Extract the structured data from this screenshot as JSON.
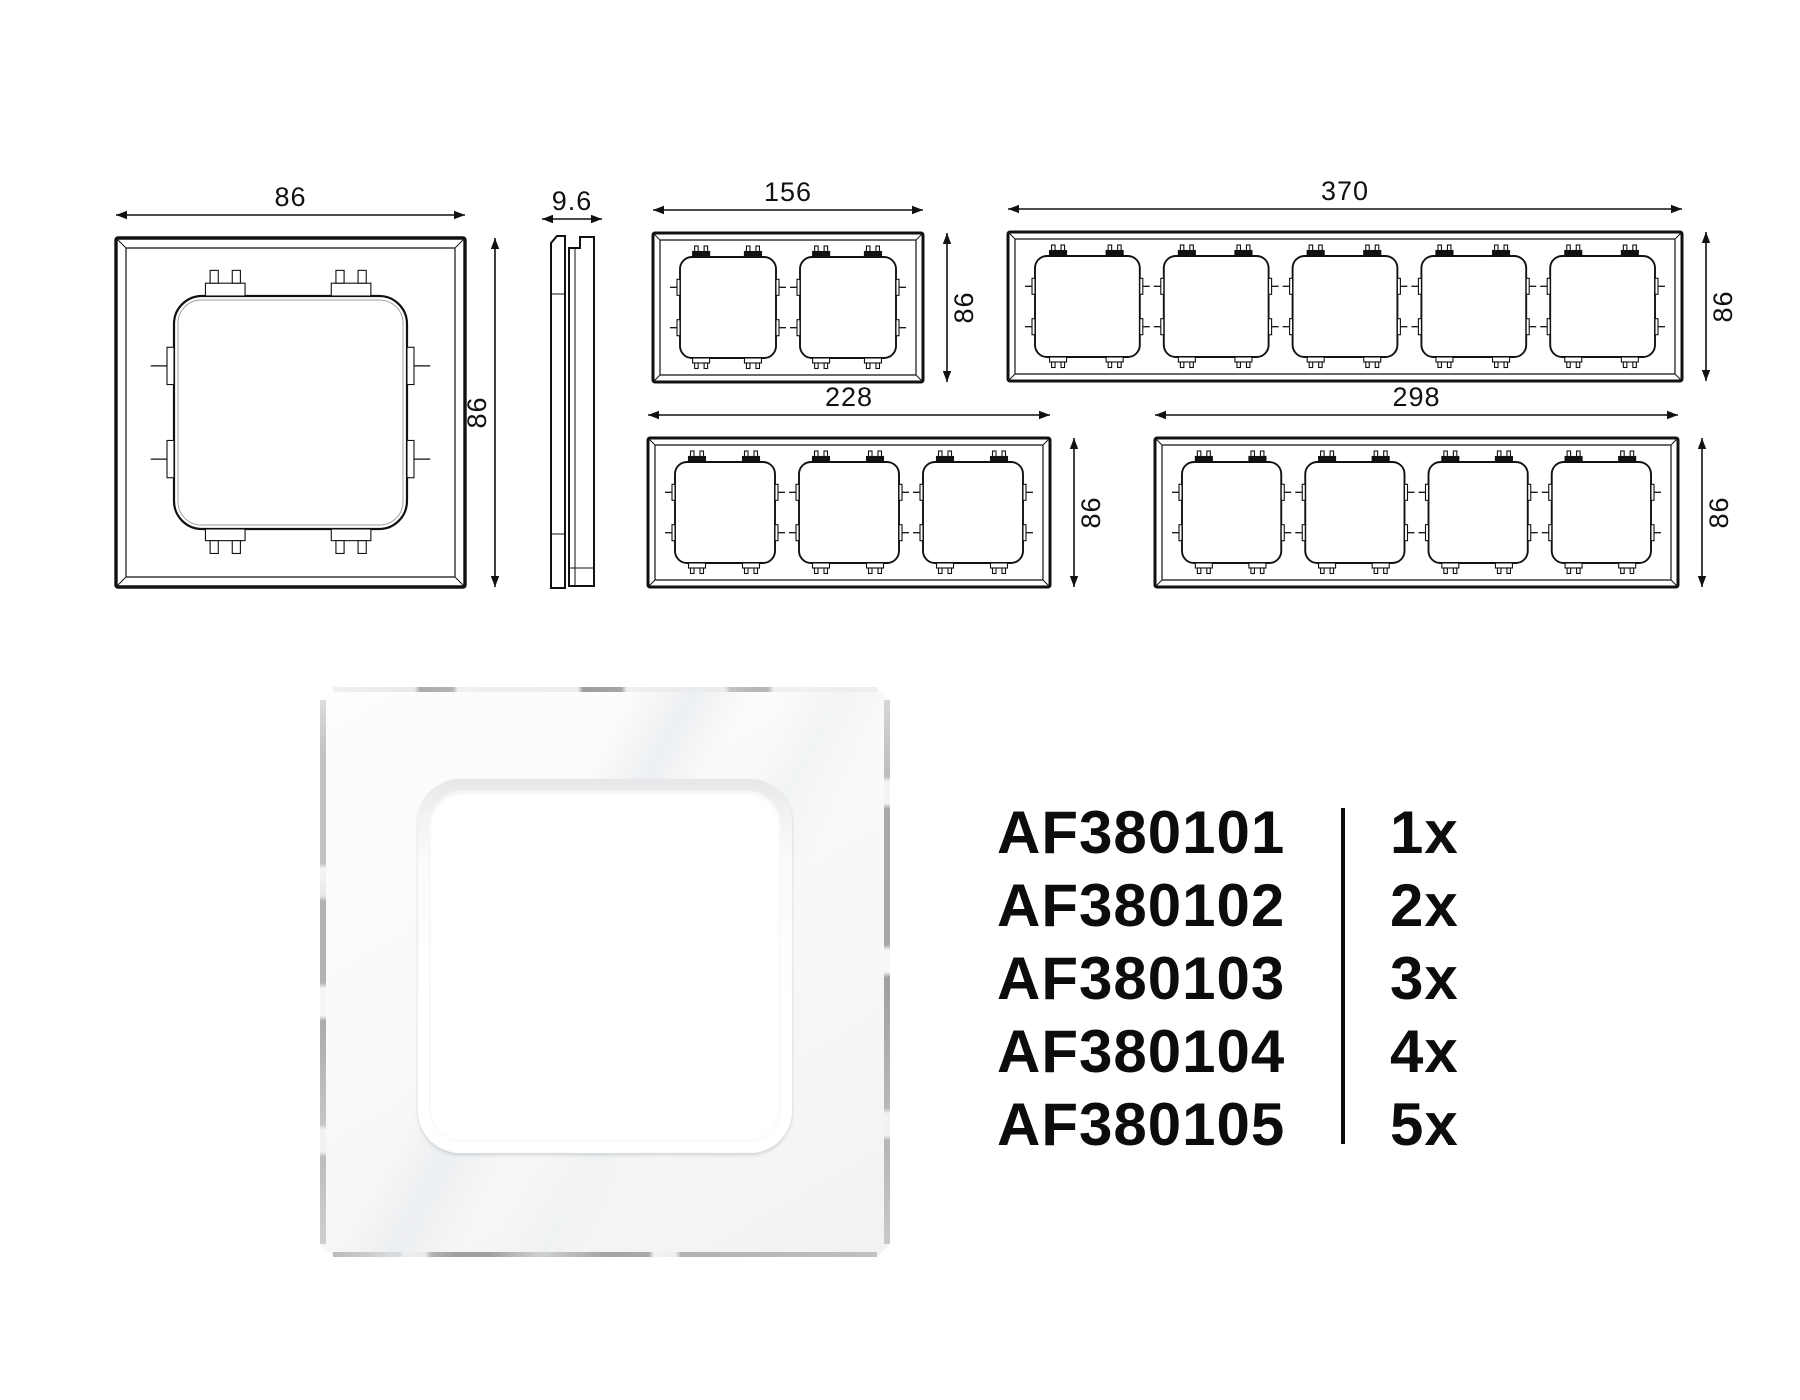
{
  "page": {
    "background_color": "#ffffff",
    "line_color": "#111111",
    "text_color": "#0c0c0c"
  },
  "drawings": {
    "single_front": {
      "gangs": 1,
      "width_label": "86",
      "height_label": "86"
    },
    "side_profile": {
      "thickness_label": "9.6"
    },
    "two_gang": {
      "gangs": 2,
      "width_label": "156",
      "height_label": "86"
    },
    "five_gang": {
      "gangs": 5,
      "width_label": "370",
      "height_label": "86"
    },
    "three_gang": {
      "gangs": 3,
      "width_label": "228",
      "height_label": "86"
    },
    "four_gang": {
      "gangs": 4,
      "width_label": "298",
      "height_label": "86"
    }
  },
  "product_table": {
    "rows": [
      {
        "code": "AF380101",
        "quantity": "1x"
      },
      {
        "code": "AF380102",
        "quantity": "2x"
      },
      {
        "code": "AF380103",
        "quantity": "3x"
      },
      {
        "code": "AF380104",
        "quantity": "4x"
      },
      {
        "code": "AF380105",
        "quantity": "5x"
      }
    ]
  }
}
